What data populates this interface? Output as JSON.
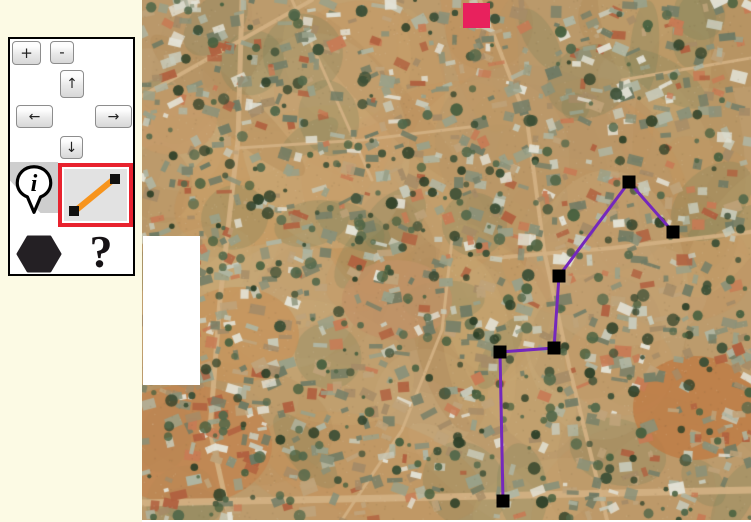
{
  "app": {
    "background_color": "#FCFAE4",
    "selection_color": "#E8222E"
  },
  "toolbar": {
    "zoom_in_label": "+",
    "zoom_out_label": "-",
    "pan_up_glyph": "↑",
    "pan_down_glyph": "↓",
    "pan_left_glyph": "←",
    "pan_right_glyph": "→",
    "help_label": "?",
    "selected_tool": "draw-line",
    "tools": [
      {
        "name": "info-marker",
        "icon": "info-pin-icon",
        "selected": false
      },
      {
        "name": "draw-line",
        "icon": "diagonal-line-icon",
        "selected": true
      },
      {
        "name": "draw-polygon",
        "icon": "hexagon-icon",
        "selected": false
      },
      {
        "name": "help",
        "icon": "question-mark-icon",
        "selected": false
      }
    ],
    "line_icon": {
      "line_color": "#F7941D",
      "endpoint_color": "#111111",
      "background": "#E2E2E2"
    },
    "info_icon": {
      "glyph": "i",
      "fill": "#ffffff",
      "stroke": "#000000"
    },
    "polygon_icon": {
      "fill": "#242024"
    }
  },
  "map": {
    "offset_x": 142,
    "width": 609,
    "height": 520,
    "marker": {
      "x": 321,
      "y": 3,
      "width": 27,
      "height": 25,
      "color": "#E8215D"
    },
    "polyline": {
      "stroke": "#7528BC",
      "stroke_width": 3,
      "vertex_fill": "#000000",
      "vertex_size": 13,
      "points": [
        [
          361,
          501
        ],
        [
          358,
          352
        ],
        [
          412,
          348
        ],
        [
          417,
          276
        ],
        [
          487,
          182
        ],
        [
          531,
          232
        ]
      ]
    },
    "blank_patch": {
      "x": 1,
      "y": 236,
      "width": 57,
      "height": 149,
      "color": "#FFFFFF"
    },
    "texture": {
      "seed": 1337,
      "base": "#BC9B6C",
      "patches": [
        "#C9A873",
        "#AD8C5C",
        "#C6935B",
        "#B28A58",
        "#CBAF82",
        "#B69468"
      ],
      "vegetation": "#6A7A58",
      "fields": [
        {
          "x": 553,
          "y": 408,
          "rx": 62,
          "ry": 52,
          "color": "#BE7B44"
        },
        {
          "x": 45,
          "y": 445,
          "rx": 85,
          "ry": 60,
          "color": "#C28550"
        },
        {
          "x": 95,
          "y": 335,
          "rx": 62,
          "ry": 48,
          "color": "#C6935B"
        },
        {
          "x": 255,
          "y": 300,
          "rx": 55,
          "ry": 40,
          "color": "#C09266"
        },
        {
          "x": 30,
          "y": 120,
          "rx": 45,
          "ry": 35,
          "color": "#C49A68"
        }
      ],
      "road_color": "#D2B183",
      "roads": [
        {
          "w": 5,
          "pts": [
            [
              100,
              0
            ],
            [
              96,
              140
            ],
            [
              78,
              300
            ],
            [
              68,
              430
            ],
            [
              88,
              520
            ]
          ]
        },
        {
          "w": 7,
          "pts": [
            [
              0,
              503
            ],
            [
              300,
              497
            ],
            [
              609,
              490
            ]
          ]
        },
        {
          "w": 4,
          "pts": [
            [
              0,
              96
            ],
            [
              170,
              0
            ]
          ]
        },
        {
          "w": 4,
          "pts": [
            [
              338,
              0
            ],
            [
              385,
              120
            ],
            [
              402,
              250
            ],
            [
              428,
              370
            ],
            [
              465,
              520
            ]
          ]
        },
        {
          "w": 4,
          "pts": [
            [
              352,
              258
            ],
            [
              470,
              248
            ],
            [
              609,
              232
            ]
          ]
        },
        {
          "w": 3,
          "pts": [
            [
              200,
              520
            ],
            [
              260,
              430
            ],
            [
              300,
              330
            ],
            [
              310,
              240
            ]
          ]
        },
        {
          "w": 3,
          "pts": [
            [
              480,
              80
            ],
            [
              609,
              58
            ]
          ]
        },
        {
          "w": 3,
          "pts": [
            [
              96,
              148
            ],
            [
              220,
              140
            ],
            [
              336,
              126
            ]
          ]
        },
        {
          "w": 3,
          "pts": [
            [
              150,
              0
            ],
            [
              190,
              90
            ],
            [
              230,
              180
            ]
          ]
        }
      ],
      "building_colors": [
        "#8A9179",
        "#99A189",
        "#767F68",
        "#AFB6A3",
        "#C8CBBB",
        "#E3E2D6",
        "#6E7A64",
        "#A58B67",
        "#BFA37A",
        "#B0603F",
        "#C77B55"
      ],
      "tree_colors": [
        "#3C4F36",
        "#48603F",
        "#2F4129",
        "#53684A"
      ],
      "building_count": 1150,
      "tree_count": 430
    }
  }
}
